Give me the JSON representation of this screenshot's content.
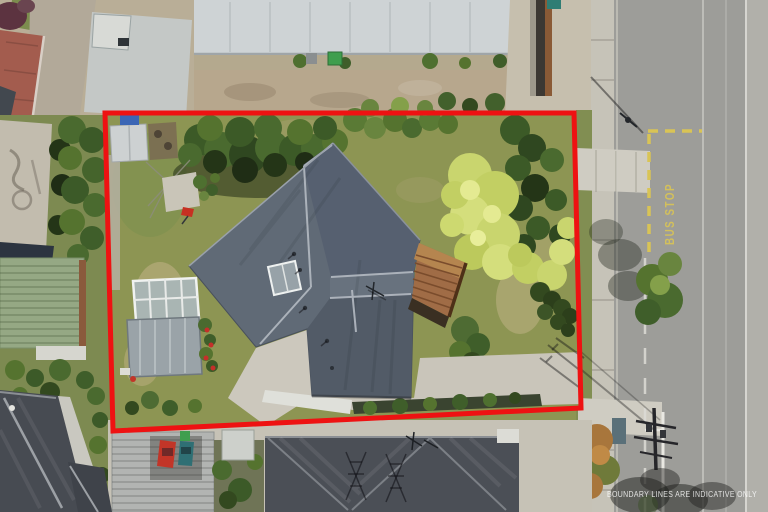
{
  "watermark": {
    "text": "BOUNDARY LINES ARE INDICATIVE ONLY"
  },
  "road": {
    "bus_stop_text": "BUS STOP",
    "marking_yellow": "#d9c455",
    "asphalt": "#9d9d99"
  },
  "boundary": {
    "points": "105,113 574,113 581,408 113,431",
    "color": "#ee1212"
  },
  "palette": {
    "main_roof": "#5d6773",
    "lawn": "#8d9553",
    "lime_hedge": "#c9d56e",
    "deck_wood": "#a06c46",
    "concrete": "#c8c5bb",
    "dark_neighbor_roof": "#4b4f56",
    "green_corrugated_roof": "#95a884",
    "brick_red_roof": "#a35c4e"
  }
}
